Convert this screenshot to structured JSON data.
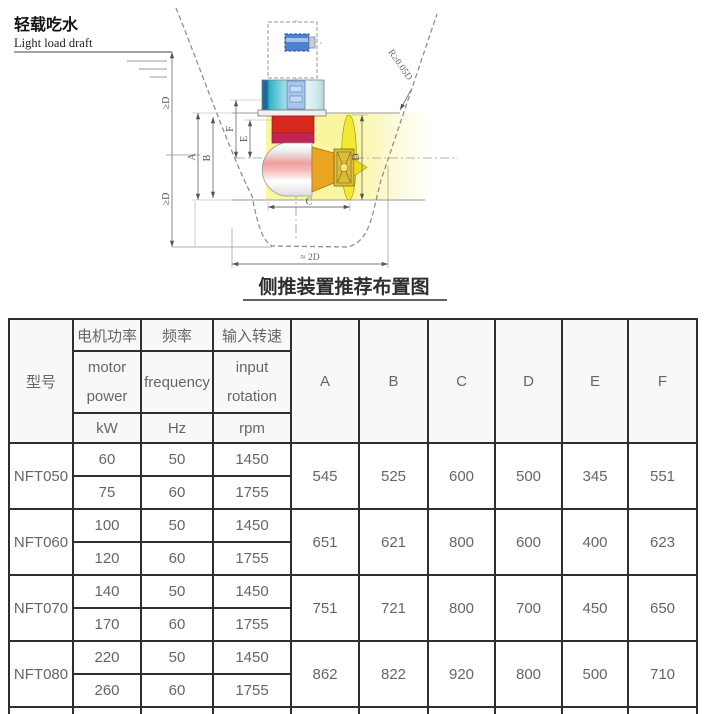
{
  "diagram": {
    "waterline_label_zh": "轻载吃水",
    "waterline_label_en": "Light load draft",
    "title": "侧推装置推荐布置图",
    "dims": {
      "above": "≥D",
      "below": "≥D",
      "radius": "R≥0.05D",
      "bottom_span": "≈ 2D",
      "a": "A",
      "b": "B",
      "c": "C",
      "d": "D",
      "e": "E",
      "f": "F"
    }
  },
  "colors": {
    "motor_blue": "#4f81d0",
    "drive_teal": "#2fb5c9",
    "gear_red": "#d7281d",
    "gear_band": "#c22553",
    "pod_pink": "#f0a0a0",
    "cone_orange": "#e9a521",
    "hub_gold": "#ddbc3c",
    "propeller_yellow": "#f2e935",
    "tunnel_yellow": "#faf6a0",
    "table_border": "#2e2e2e",
    "table_header_bg": "#f8f8f8",
    "table_text": "#666666"
  },
  "table": {
    "header": {
      "model": "型号",
      "groups": [
        {
          "zh": "电机功率",
          "en1": "motor",
          "en2": "power",
          "unit": "kW"
        },
        {
          "zh": "频率",
          "en1": "frequency",
          "en2": "",
          "unit": "Hz"
        },
        {
          "zh": "输入转速",
          "en1": "input",
          "en2": "rotation",
          "unit": "rpm"
        }
      ],
      "dim_cols": [
        "A",
        "B",
        "C",
        "D",
        "E",
        "F"
      ]
    },
    "rows": [
      {
        "model": "NFT050",
        "variants": [
          {
            "kw": "60",
            "hz": "50",
            "rpm": "1450"
          },
          {
            "kw": "75",
            "hz": "60",
            "rpm": "1755"
          }
        ],
        "A": "545",
        "B": "525",
        "C": "600",
        "D": "500",
        "E": "345",
        "F": "551"
      },
      {
        "model": "NFT060",
        "variants": [
          {
            "kw": "100",
            "hz": "50",
            "rpm": "1450"
          },
          {
            "kw": "120",
            "hz": "60",
            "rpm": "1755"
          }
        ],
        "A": "651",
        "B": "621",
        "C": "800",
        "D": "600",
        "E": "400",
        "F": "623"
      },
      {
        "model": "NFT070",
        "variants": [
          {
            "kw": "140",
            "hz": "50",
            "rpm": "1450"
          },
          {
            "kw": "170",
            "hz": "60",
            "rpm": "1755"
          }
        ],
        "A": "751",
        "B": "721",
        "C": "800",
        "D": "700",
        "E": "450",
        "F": "650"
      },
      {
        "model": "NFT080",
        "variants": [
          {
            "kw": "220",
            "hz": "50",
            "rpm": "1450"
          },
          {
            "kw": "260",
            "hz": "60",
            "rpm": "1755"
          }
        ],
        "A": "862",
        "B": "822",
        "C": "920",
        "D": "800",
        "E": "500",
        "F": "710"
      }
    ]
  }
}
